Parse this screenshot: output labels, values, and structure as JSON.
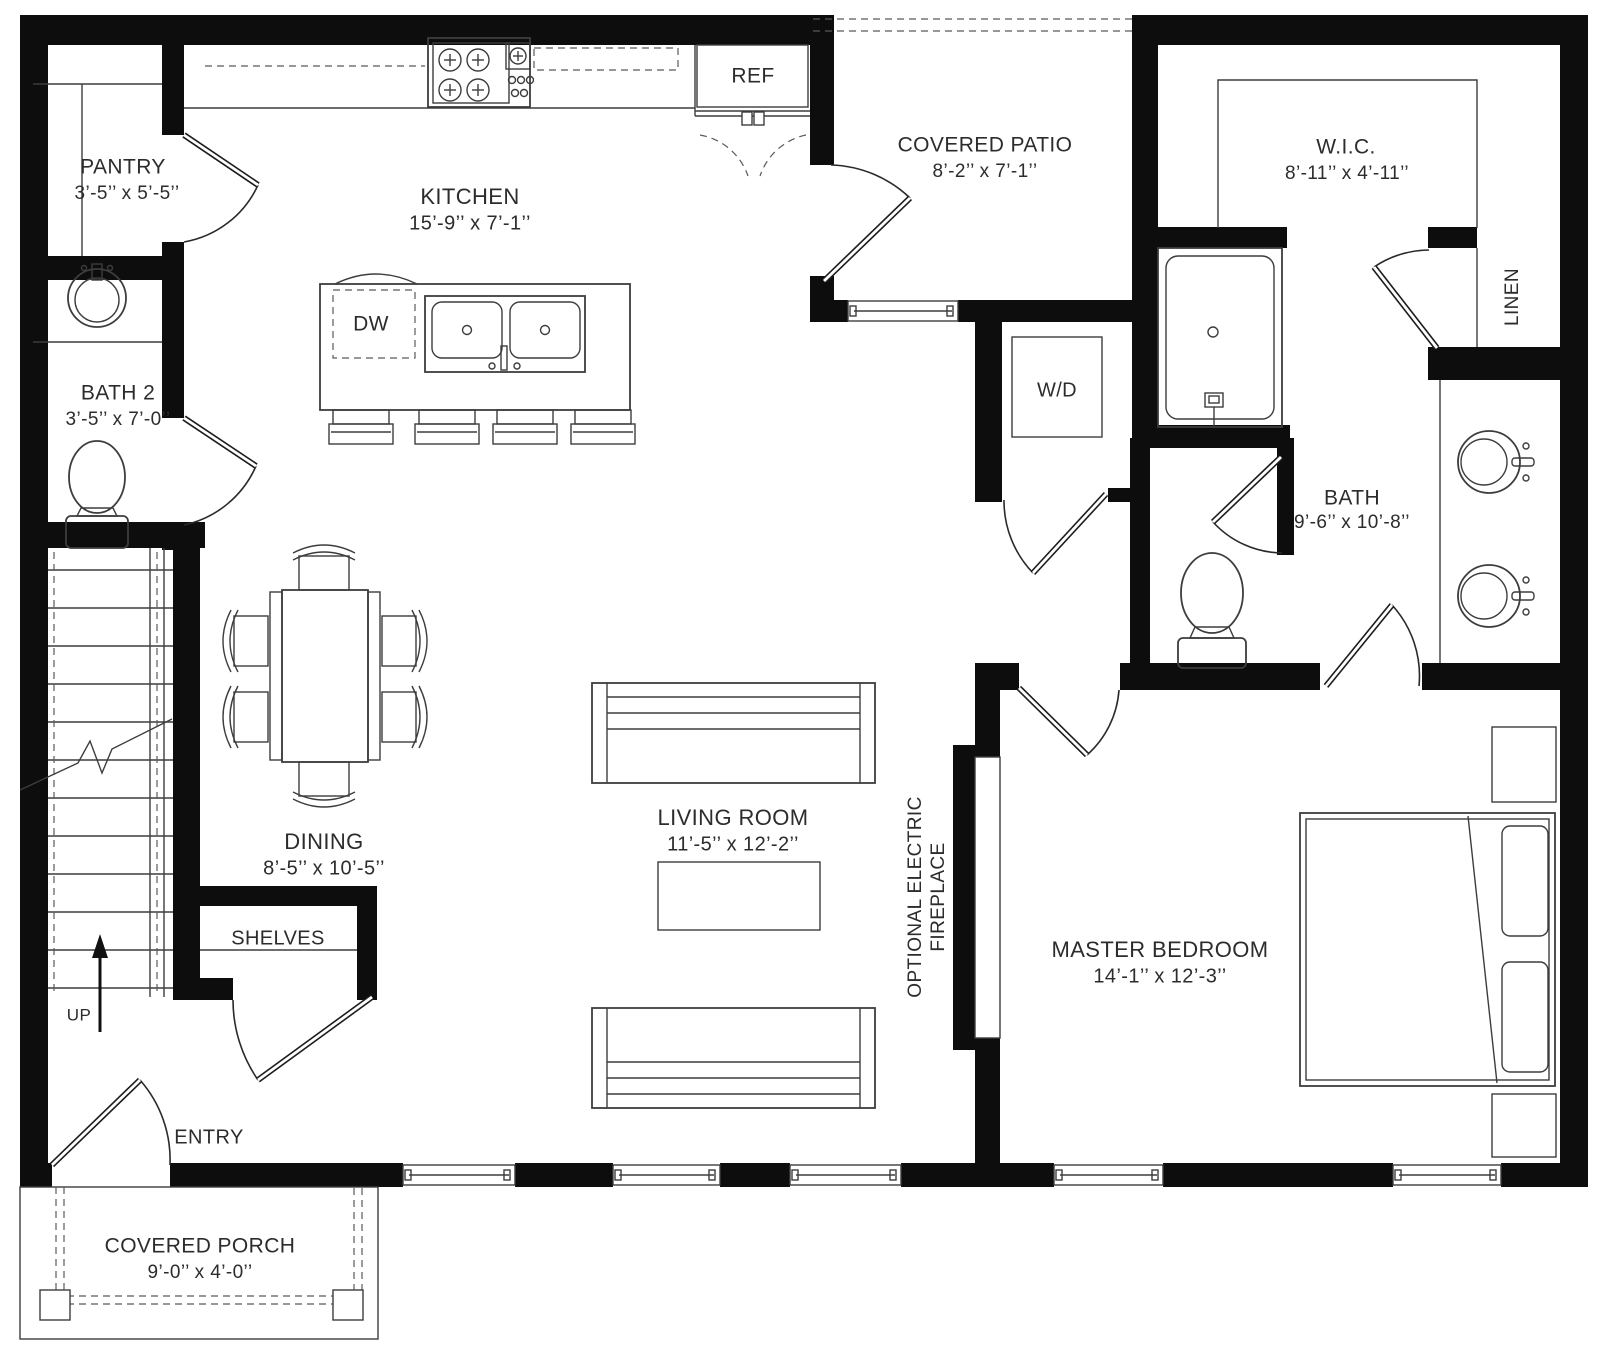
{
  "title": "Floor Plan",
  "colors": {
    "wall": "#0d0d0d",
    "line": "#3d3d3d",
    "text": "#2c2c2c",
    "background": "#ffffff"
  },
  "rooms": {
    "pantry": {
      "name": "PANTRY",
      "dims": "3’-5’’ x 5’-5’’"
    },
    "kitchen": {
      "name": "KITCHEN",
      "dims": "15’-9’’ x 7’-1’’"
    },
    "covered_patio": {
      "name": "COVERED PATIO",
      "dims": "8’-2’’ x 7’-1’’"
    },
    "wic": {
      "name": "W.I.C.",
      "dims": "8’-11’’ x 4’-11’’"
    },
    "bath2": {
      "name": "BATH 2",
      "dims": "3’-5’’ x 7’-0’’"
    },
    "bath": {
      "name": "BATH",
      "dims": "9’-6’’ x 10’-8’’"
    },
    "dining": {
      "name": "DINING",
      "dims": "8’-5’’ x 10’-5’’"
    },
    "living_room": {
      "name": "LIVING ROOM",
      "dims": "11’-5’’ x 12’-2’’"
    },
    "master_bedroom": {
      "name": "MASTER BEDROOM",
      "dims": "14’-1’’ x 12’-3’’"
    },
    "covered_porch": {
      "name": "COVERED PORCH",
      "dims": "9’-0’’ x 4’-0’’"
    }
  },
  "labels": {
    "entry": "ENTRY",
    "shelves": "SHELVES",
    "ref": "REF",
    "dw": "DW",
    "wd": "W/D",
    "up": "UP",
    "linen": "LINEN",
    "fireplace_line1": "OPTIONAL ELECTRIC",
    "fireplace_line2": "FIREPLACE"
  }
}
